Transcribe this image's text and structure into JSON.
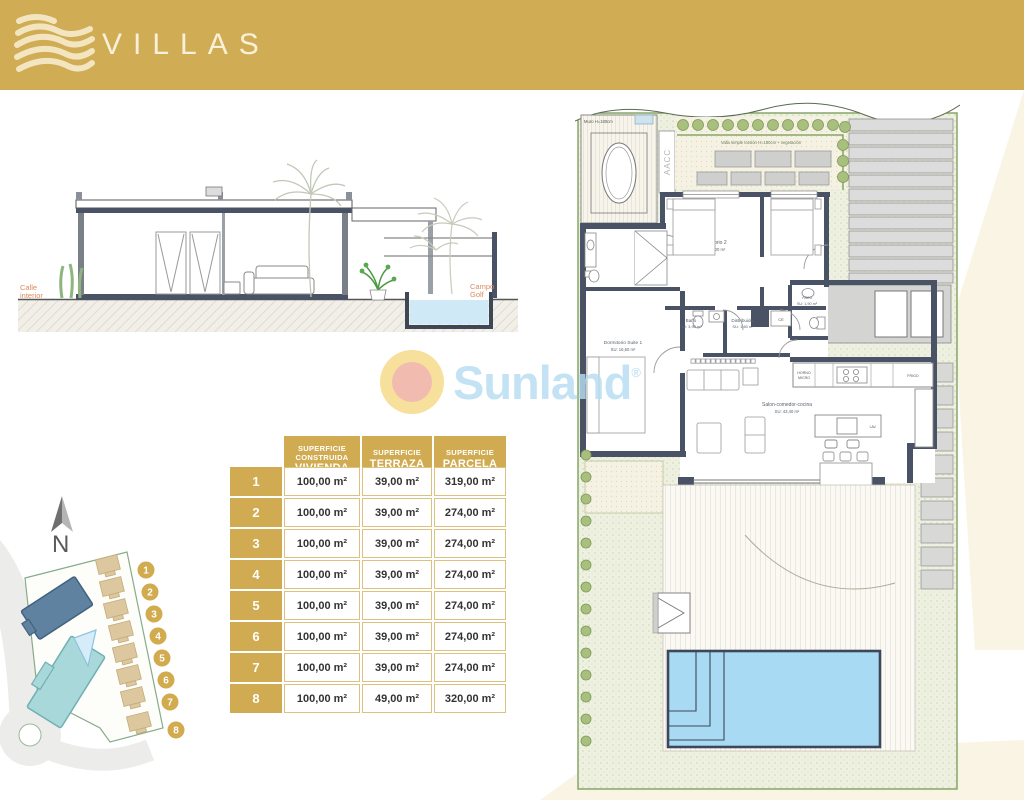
{
  "header": {
    "title": "VILLAS"
  },
  "watermark": {
    "brand": "Sunland",
    "reg": "®"
  },
  "elevation": {
    "left_label_1": "Calle",
    "left_label_2": "interior",
    "right_label_1": "Campo",
    "right_label_2": "Golf"
  },
  "table": {
    "villa_header": "VILLA",
    "columns": [
      {
        "top1": "SUPERFICIE",
        "top2": "CONSTRUIDA",
        "main": "VIVIENDA"
      },
      {
        "top1": "SUPERFICIE",
        "top2": "",
        "main": "TERRAZA"
      },
      {
        "top1": "SUPERFICIE",
        "top2": "",
        "main": "PARCELA"
      }
    ],
    "rows": [
      {
        "villa": "1",
        "vivienda": "100,00 m²",
        "terraza": "39,00 m²",
        "parcela": "319,00 m²"
      },
      {
        "villa": "2",
        "vivienda": "100,00 m²",
        "terraza": "39,00 m²",
        "parcela": "274,00 m²"
      },
      {
        "villa": "3",
        "vivienda": "100,00 m²",
        "terraza": "39,00 m²",
        "parcela": "274,00 m²"
      },
      {
        "villa": "4",
        "vivienda": "100,00 m²",
        "terraza": "39,00 m²",
        "parcela": "274,00 m²"
      },
      {
        "villa": "5",
        "vivienda": "100,00 m²",
        "terraza": "39,00 m²",
        "parcela": "274,00 m²"
      },
      {
        "villa": "6",
        "vivienda": "100,00 m²",
        "terraza": "39,00 m²",
        "parcela": "274,00 m²"
      },
      {
        "villa": "7",
        "vivienda": "100,00 m²",
        "terraza": "39,00 m²",
        "parcela": "274,00 m²"
      },
      {
        "villa": "8",
        "vivienda": "100,00 m²",
        "terraza": "49,00 m²",
        "parcela": "320,00 m²"
      }
    ]
  },
  "siteplan": {
    "north": "N",
    "badges": [
      "1",
      "2",
      "3",
      "4",
      "5",
      "6",
      "7",
      "8"
    ]
  },
  "floorplan": {
    "muro": "Muro H=180cm",
    "fence": "Valla simple torsión H=180cm + vegetación",
    "aacc": "AACC",
    "dorm2_name": "Dormitorio 2",
    "dorm2_su": "SU: 10,00 m²",
    "dorm3_name": "Dormitorio 3",
    "dorm3_su": "SU: 10,00 m²",
    "bano_name": "Baño",
    "bano_su": "SU: 3,90 m²",
    "distr_name": "Distribuidor",
    "distr_su": "SU: 1,60 m²",
    "aseo_name": "Aseo",
    "aseo_su": "SU: 1,90 m²",
    "suite_name": "Dormitorio Suite 1",
    "suite_su": "SU: 16,60 m²",
    "salon_name": "Salon-comedor-cocina",
    "salon_su": "SU: 43,40 m²",
    "horno1": "HORNO",
    "horno2": "MICRO",
    "frigo": "FRIGO",
    "lav": "LAV.",
    "ce": "CE"
  },
  "colors": {
    "gold": "#d0ab52",
    "wall": "#4a5365",
    "pool": "#a9daf4",
    "brand_blue": "#b7ddf2"
  }
}
